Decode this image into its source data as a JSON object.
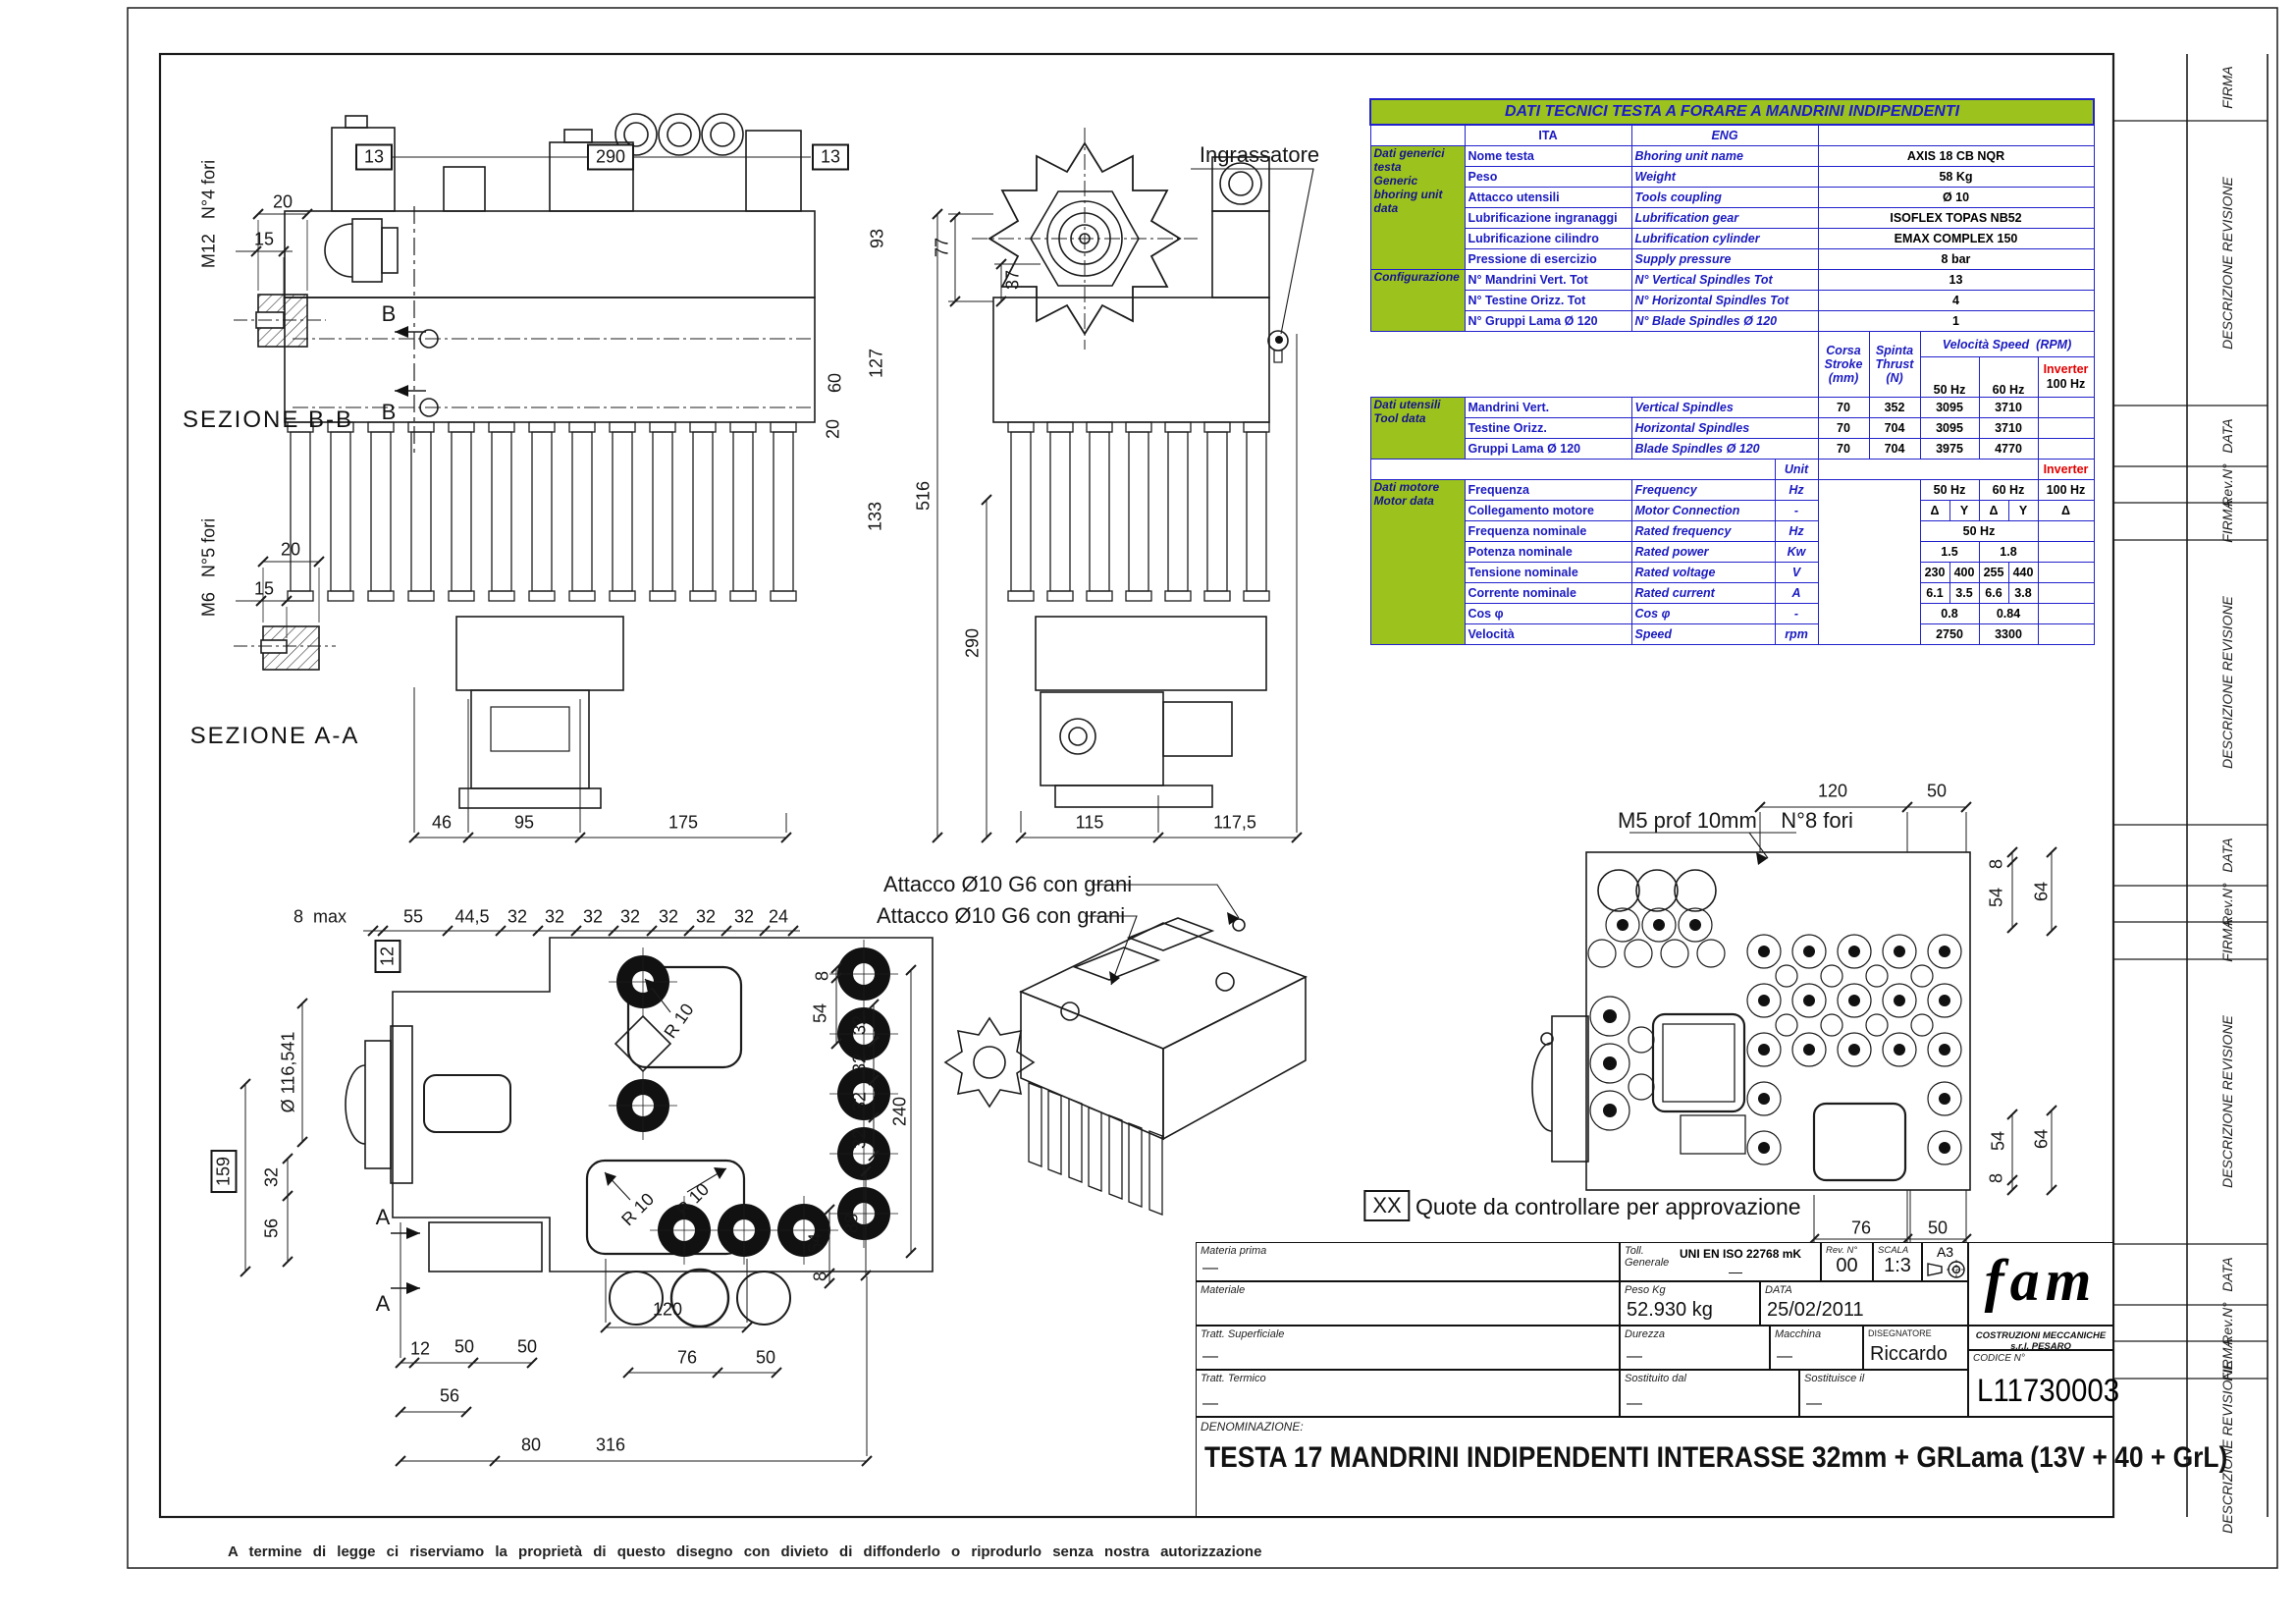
{
  "colors": {
    "table_green": "#9CC21E",
    "table_border": "#2121CC",
    "table_text_blue": "#1A1AC0",
    "accent_red": "#E10000",
    "line": "#1C1C1C"
  },
  "table": {
    "title": "DATI TECNICI TESTA A FORARE A MANDRINI INDIPENDENTI",
    "col_ita": "ITA",
    "col_eng": "ENG",
    "general": {
      "label": "Dati generici\ntesta\nGeneric\nbhoring unit\ndata",
      "rows": [
        {
          "ita": "Nome testa",
          "eng": "Bhoring unit name",
          "val": "AXIS 18 CB NQR"
        },
        {
          "ita": "Peso",
          "eng": "Weight",
          "val": "58 Kg"
        },
        {
          "ita": "Attacco utensili",
          "eng": "Tools coupling",
          "val": "Ø 10"
        },
        {
          "ita": "Lubrificazione ingranaggi",
          "eng": "Lubrification gear",
          "val": "ISOFLEX TOPAS NB52"
        },
        {
          "ita": "Lubrificazione cilindro",
          "eng": "Lubrification cylinder",
          "val": "EMAX COMPLEX 150"
        },
        {
          "ita": "Pressione di esercizio",
          "eng": "Supply pressure",
          "val": "8 bar"
        }
      ]
    },
    "config": {
      "label": "Configurazione",
      "rows": [
        {
          "ita": "N° Mandrini Vert. Tot",
          "eng": "N° Vertical Spindles Tot",
          "val": "13"
        },
        {
          "ita": "N° Testine Orizz. Tot",
          "eng": "N° Horizontal Spindles Tot",
          "val": "4"
        },
        {
          "ita": "N° Gruppi Lama Ø 120",
          "eng": "N° Blade Spindles Ø 120",
          "val": "1"
        }
      ]
    },
    "mid": {
      "corsa": "Corsa\nStroke\n(mm)",
      "spinta": "Spinta\nThrust\n(N)",
      "velocita": "Velocità Speed",
      "rpm": "(RPM)",
      "hz50": "50 Hz",
      "hz60": "60 Hz",
      "inverter": "Inverter",
      "hz100": "100 Hz"
    },
    "tools": {
      "label": "Dati utensili\nTool data",
      "rows": [
        {
          "ita": "Mandrini Vert.",
          "eng": "Vertical Spindles",
          "corsa": "70",
          "spinta": "352",
          "hz50": "3095",
          "hz60": "3710",
          "inv": ""
        },
        {
          "ita": "Testine Orizz.",
          "eng": "Horizontal Spindles",
          "corsa": "70",
          "spinta": "704",
          "hz50": "3095",
          "hz60": "3710",
          "inv": ""
        },
        {
          "ita": "Gruppi Lama Ø 120",
          "eng": "Blade Spindles Ø 120",
          "corsa": "70",
          "spinta": "704",
          "hz50": "3975",
          "hz60": "4770",
          "inv": ""
        }
      ]
    },
    "unit_row": {
      "unit": "Unit",
      "inverter": "Inverter"
    },
    "motor": {
      "label": "Dati motore\nMotor data",
      "rows": [
        {
          "ita": "Frequenza",
          "eng": "Frequency",
          "unit": "Hz",
          "c1": "50 Hz",
          "c2": "60 Hz",
          "c3": "100 Hz"
        },
        {
          "ita": "Collegamento motore",
          "eng": "Motor Connection",
          "unit": "-",
          "c1": "Δ",
          "c2": "Y",
          "c3": "Δ",
          "c4": "Y",
          "c5": "Δ"
        },
        {
          "ita": "Frequenza nominale",
          "eng": "Rated frequency",
          "unit": "Hz",
          "c1": "50 Hz",
          "c2": ""
        },
        {
          "ita": "Potenza nominale",
          "eng": "Rated power",
          "unit": "Kw",
          "c1": "1.5",
          "c2": "1.8",
          "c3": ""
        },
        {
          "ita": "Tensione nominale",
          "eng": "Rated voltage",
          "unit": "V",
          "c1": "230",
          "c2": "400",
          "c3": "255",
          "c4": "440",
          "c5": ""
        },
        {
          "ita": "Corrente nominale",
          "eng": "Rated current",
          "unit": "A",
          "c1": "6.1",
          "c2": "3.5",
          "c3": "6.6",
          "c4": "3.8",
          "c5": ""
        },
        {
          "ita": "Cos φ",
          "eng": "Cos φ",
          "unit": "-",
          "c1": "0.8",
          "c2": "0.84",
          "c3": ""
        },
        {
          "ita": "Velocità",
          "eng": "Speed",
          "unit": "rpm",
          "c1": "2750",
          "c2": "3300",
          "c3": ""
        }
      ]
    }
  },
  "views": {
    "sezione_bb": {
      "title": "SEZIONE B-B",
      "thread": "M12   N°4 fori",
      "d20": "20",
      "d15": "15"
    },
    "sezione_aa": {
      "title": "SEZIONE A-A",
      "thread": "M6   N°5 fori",
      "d20": "20",
      "d15": "15"
    },
    "front": {
      "box13_left": "13",
      "box290": "290",
      "box13_right": "13",
      "section_letter": "B",
      "d93": "93",
      "d127": "127",
      "d60": "60",
      "d20": "20",
      "d133": "133",
      "d46": "46",
      "d95": "95",
      "d175": "175"
    },
    "side": {
      "ingrassatore": "Ingrassatore",
      "d77": "77",
      "d37": "37",
      "d516": "516",
      "d290": "290",
      "d115": "115",
      "d117_5": "117,5"
    },
    "bottom": {
      "d8max": "8  max",
      "d55": "55",
      "d44_5": "44,5",
      "d32": "32",
      "d24": "24",
      "box12": "12",
      "dia": "Ø 116,541",
      "box159": "159",
      "d56": "56",
      "d12": "12",
      "d50": "50",
      "d80": "80",
      "d316": "316",
      "d120": "120",
      "d76": "76",
      "d240": "240",
      "d88": "88",
      "d54": "54",
      "d8": "8",
      "r10": "R 10",
      "section_letter": "A"
    },
    "iso": {
      "attacco": "Attacco Ø10 G6 con grani"
    },
    "top": {
      "m5": "M5 prof 10mm    N°8 fori",
      "d120": "120",
      "d50": "50",
      "d8": "8",
      "d54": "54",
      "d64": "64",
      "d76": "76",
      "d80": "80"
    }
  },
  "notes": {
    "xx": "XX",
    "approval": "Quote da controllare per approvazione",
    "disclaimer": "A termine di legge ci riserviamo la proprietà di questo disegno con divieto di diffonderlo o riprodurlo senza nostra autorizzazione"
  },
  "revstrip": {
    "firma": "FIRMA",
    "descrizione": "DESCRIZIONE REVISIONE",
    "data": "DATA",
    "rev": "Rev.N°"
  },
  "titleblock": {
    "materia_prima_label": "Materia prima",
    "materia_prima": "—",
    "materiale_label": "Materiale",
    "materiale": "",
    "tratt_sup_label": "Tratt. Superficiale",
    "tratt_sup": "—",
    "tratt_term_label": "Tratt. Termico",
    "tratt_term": "—",
    "toll_label": "Toll.\nGenerale",
    "toll_value": "UNI EN ISO 22768 mK",
    "toll_dash": "—",
    "rev_label": "Rev. N°",
    "rev": "00",
    "scala_label": "SCALA",
    "scala": "1:3",
    "format": "A3",
    "peso_label": "Peso Kg",
    "peso": "52.930 kg",
    "data_label": "DATA",
    "data": "25/02/2011",
    "durezza_label": "Durezza",
    "durezza": "—",
    "macchina_label": "Macchina",
    "macchina": "—",
    "disegnatore_label": "DISEGNATORE",
    "disegnatore": "Riccardo",
    "sost_dal_label": "Sostituito dal",
    "sost_dal": "—",
    "sost_il_label": "Sostituisce il",
    "sost_il": "—",
    "logo": "fam",
    "company": "COSTRUZIONI MECCANICHE s.r.l. PESARO",
    "codice_label": "CODICE N°",
    "codice": "L11730003",
    "denominazione_label": "DENOMINAZIONE:",
    "denominazione": "TESTA 17 MANDRINI INDIPENDENTI INTERASSE 32mm + GRLama (13V + 40 + GrL)"
  }
}
